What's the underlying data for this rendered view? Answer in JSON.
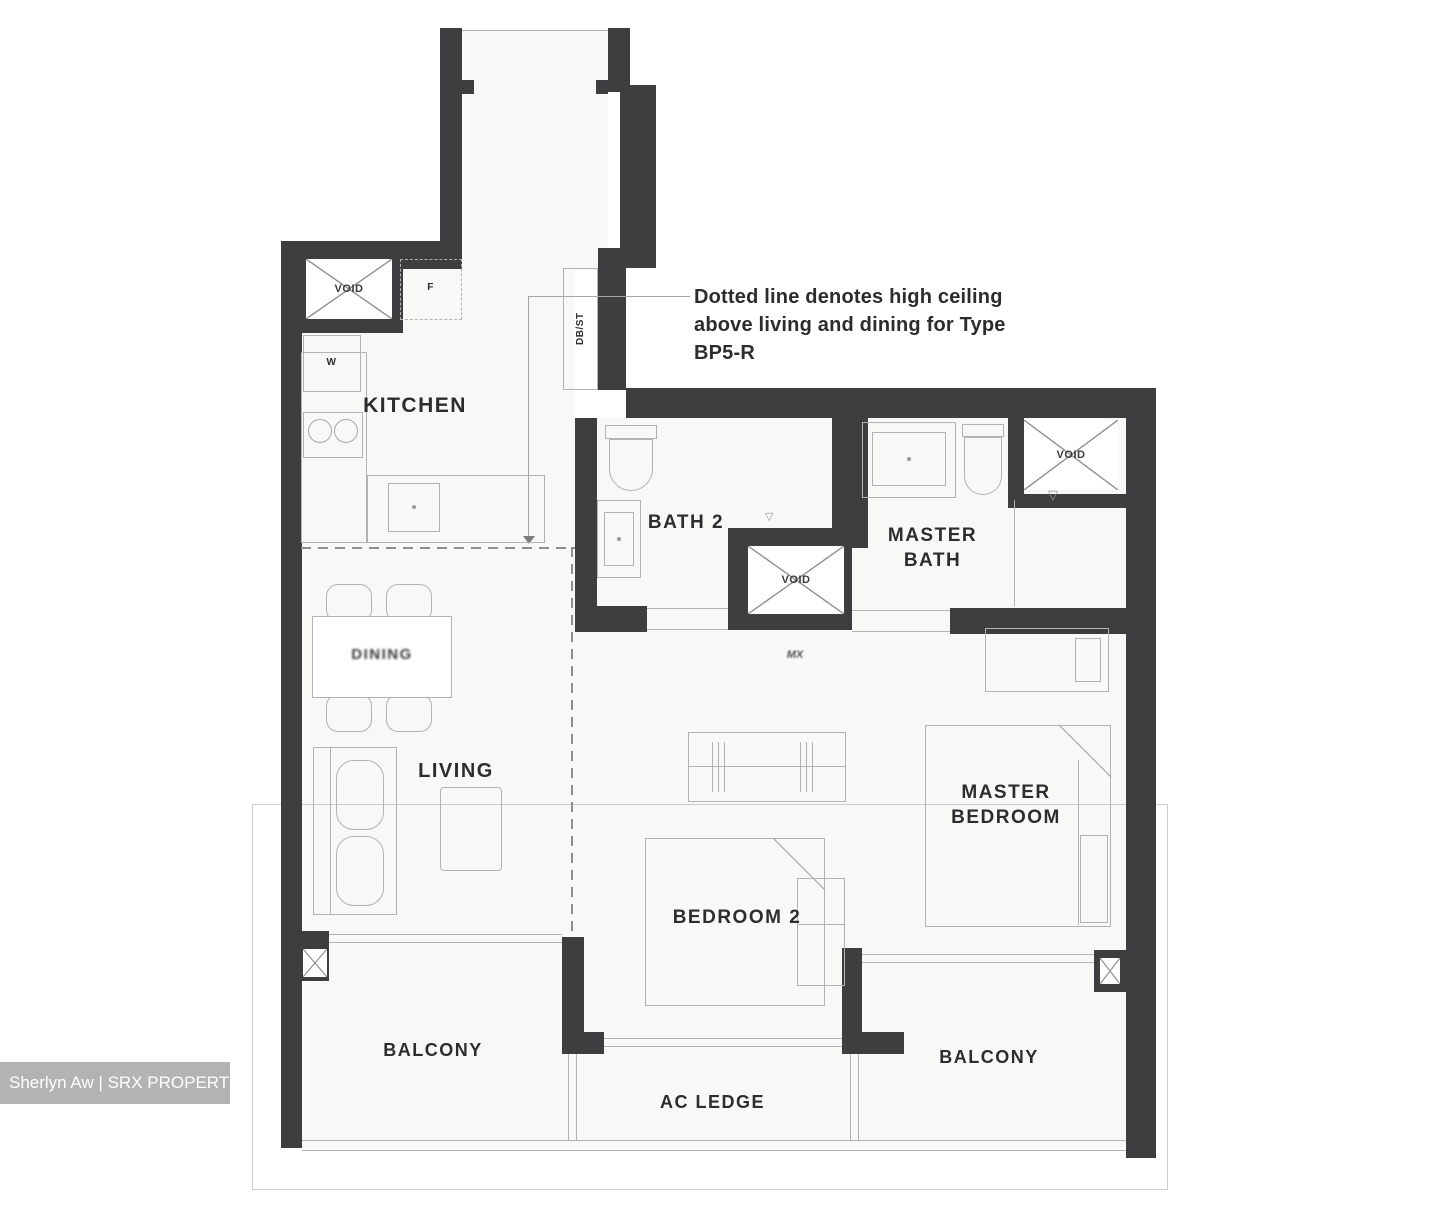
{
  "floorplan": {
    "rooms": {
      "kitchen": "KITCHEN",
      "bath2": "BATH 2",
      "master_bath": "MASTER BATH",
      "living": "LIVING",
      "dining": "DINING",
      "bedroom2": "BEDROOM 2",
      "master_bedroom": "MASTER BEDROOM",
      "balcony": "BALCONY",
      "ac_ledge": "AC LEDGE"
    },
    "labels": {
      "void": "VOID",
      "fridge": "F",
      "washer": "W",
      "db_st": "DB/ST",
      "hall_mark": "MX"
    },
    "annotation": {
      "line1": "Dotted line denotes high ceiling",
      "line2": "above living and dining for Type",
      "line3": "BP5-R"
    },
    "watermark": {
      "text": "Sherlyn Aw | SRX PROPERTY"
    },
    "colors": {
      "wall": "#3e3e41",
      "thin_line": "#b3b3b3",
      "text": "#2d2d2f"
    }
  }
}
